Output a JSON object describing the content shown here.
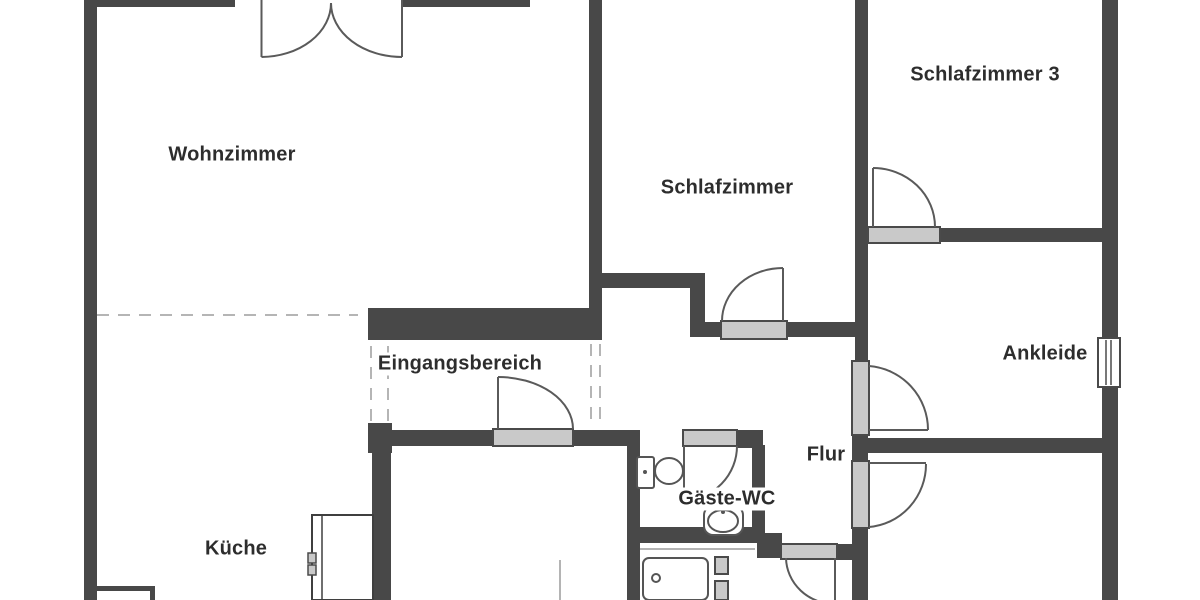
{
  "plan": {
    "type": "apartment-floor-plan",
    "language": "de"
  },
  "rooms": [
    {
      "id": "wohnzimmer",
      "name": "Wohnzimmer"
    },
    {
      "id": "schlafzimmer",
      "name": "Schlafzimmer"
    },
    {
      "id": "schlafzimmer3",
      "name": "Schlafzimmer 3"
    },
    {
      "id": "eingangsbereich",
      "name": "Eingangsbereich"
    },
    {
      "id": "ankleide",
      "name": "Ankleide"
    },
    {
      "id": "flur",
      "name": "Flur"
    },
    {
      "id": "gaeste_wc",
      "name": "Gäste-WC"
    },
    {
      "id": "kueche",
      "name": "Küche"
    }
  ],
  "fixtures": [
    "toilet",
    "washbasin",
    "shower-tray",
    "kitchen-appliance",
    "window",
    "double-door",
    "single-doors"
  ],
  "colors": {
    "wall": "#484848",
    "door_sill_fill": "#c9c9c9",
    "door_sill_border": "#4a4a4a",
    "door_swing_line": "#5a5a5a",
    "dashed_boundary": "#b5b5b5",
    "label_text": "#2d2d2d",
    "background": "#ffffff"
  }
}
